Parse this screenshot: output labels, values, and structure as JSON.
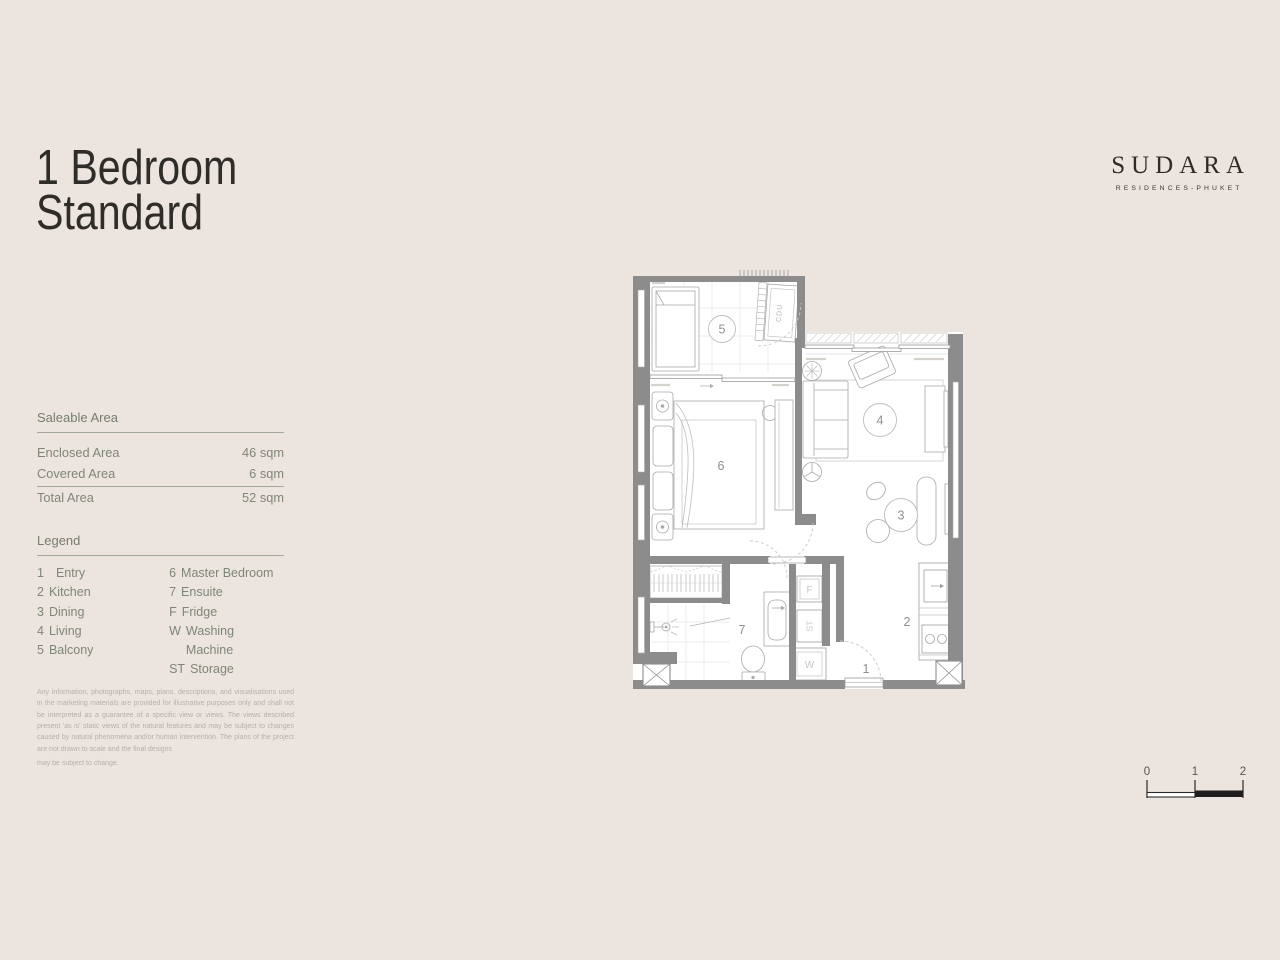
{
  "page": {
    "background_color": "#ece4de",
    "accent_text_color": "#7f8678",
    "wall_color": "#8c8c8c"
  },
  "title": {
    "line1": "1 Bedroom",
    "line2": "Standard"
  },
  "logo": {
    "brand": "SUDARA",
    "tagline": "RESIDENCES-PHUKET"
  },
  "saleable_area": {
    "heading": "Saleable Area",
    "rows": [
      {
        "label": "Enclosed Area",
        "value": "46 sqm"
      },
      {
        "label": "Covered Area",
        "value": "6 sqm"
      },
      {
        "label": "Total Area",
        "value": "52 sqm"
      }
    ]
  },
  "legend": {
    "heading": "Legend",
    "col1": [
      {
        "key": "1",
        "label": "Entry"
      },
      {
        "key": "2",
        "label": "Kitchen"
      },
      {
        "key": "3",
        "label": "Dining"
      },
      {
        "key": "4",
        "label": "Living"
      },
      {
        "key": "5",
        "label": "Balcony"
      }
    ],
    "col2": [
      {
        "key": "6",
        "label": "Master Bedroom"
      },
      {
        "key": "7",
        "label": "Ensuite"
      },
      {
        "key": "F",
        "label": "Fridge"
      },
      {
        "key": "W",
        "label": "Washing Machine"
      },
      {
        "key": "ST",
        "label": "Storage"
      }
    ]
  },
  "disclaimer": {
    "p1": "Any information, photographs, maps, plans, descriptions, and visualisations used in the marketing materials are provided for illustrative purposes only and shall not be interpreted as a guarantee of a specific view or views. The views described present 'as is' static views of the natural features and may be subject to changes caused by natural phenomena and/or human intervention. The plans of the project are not drawn to scale and the final designs",
    "p2": "may be subject to change."
  },
  "floor_plan": {
    "labels": {
      "entry": "1",
      "kitchen": "2",
      "dining": "3",
      "living": "4",
      "balcony": "5",
      "master_bedroom": "6",
      "ensuite": "7",
      "fridge": "F",
      "storage": "ST",
      "washing_machine": "W",
      "cdu": "CDU"
    }
  },
  "scale_bar": {
    "t0": "0",
    "t1": "1",
    "t2": "2"
  }
}
